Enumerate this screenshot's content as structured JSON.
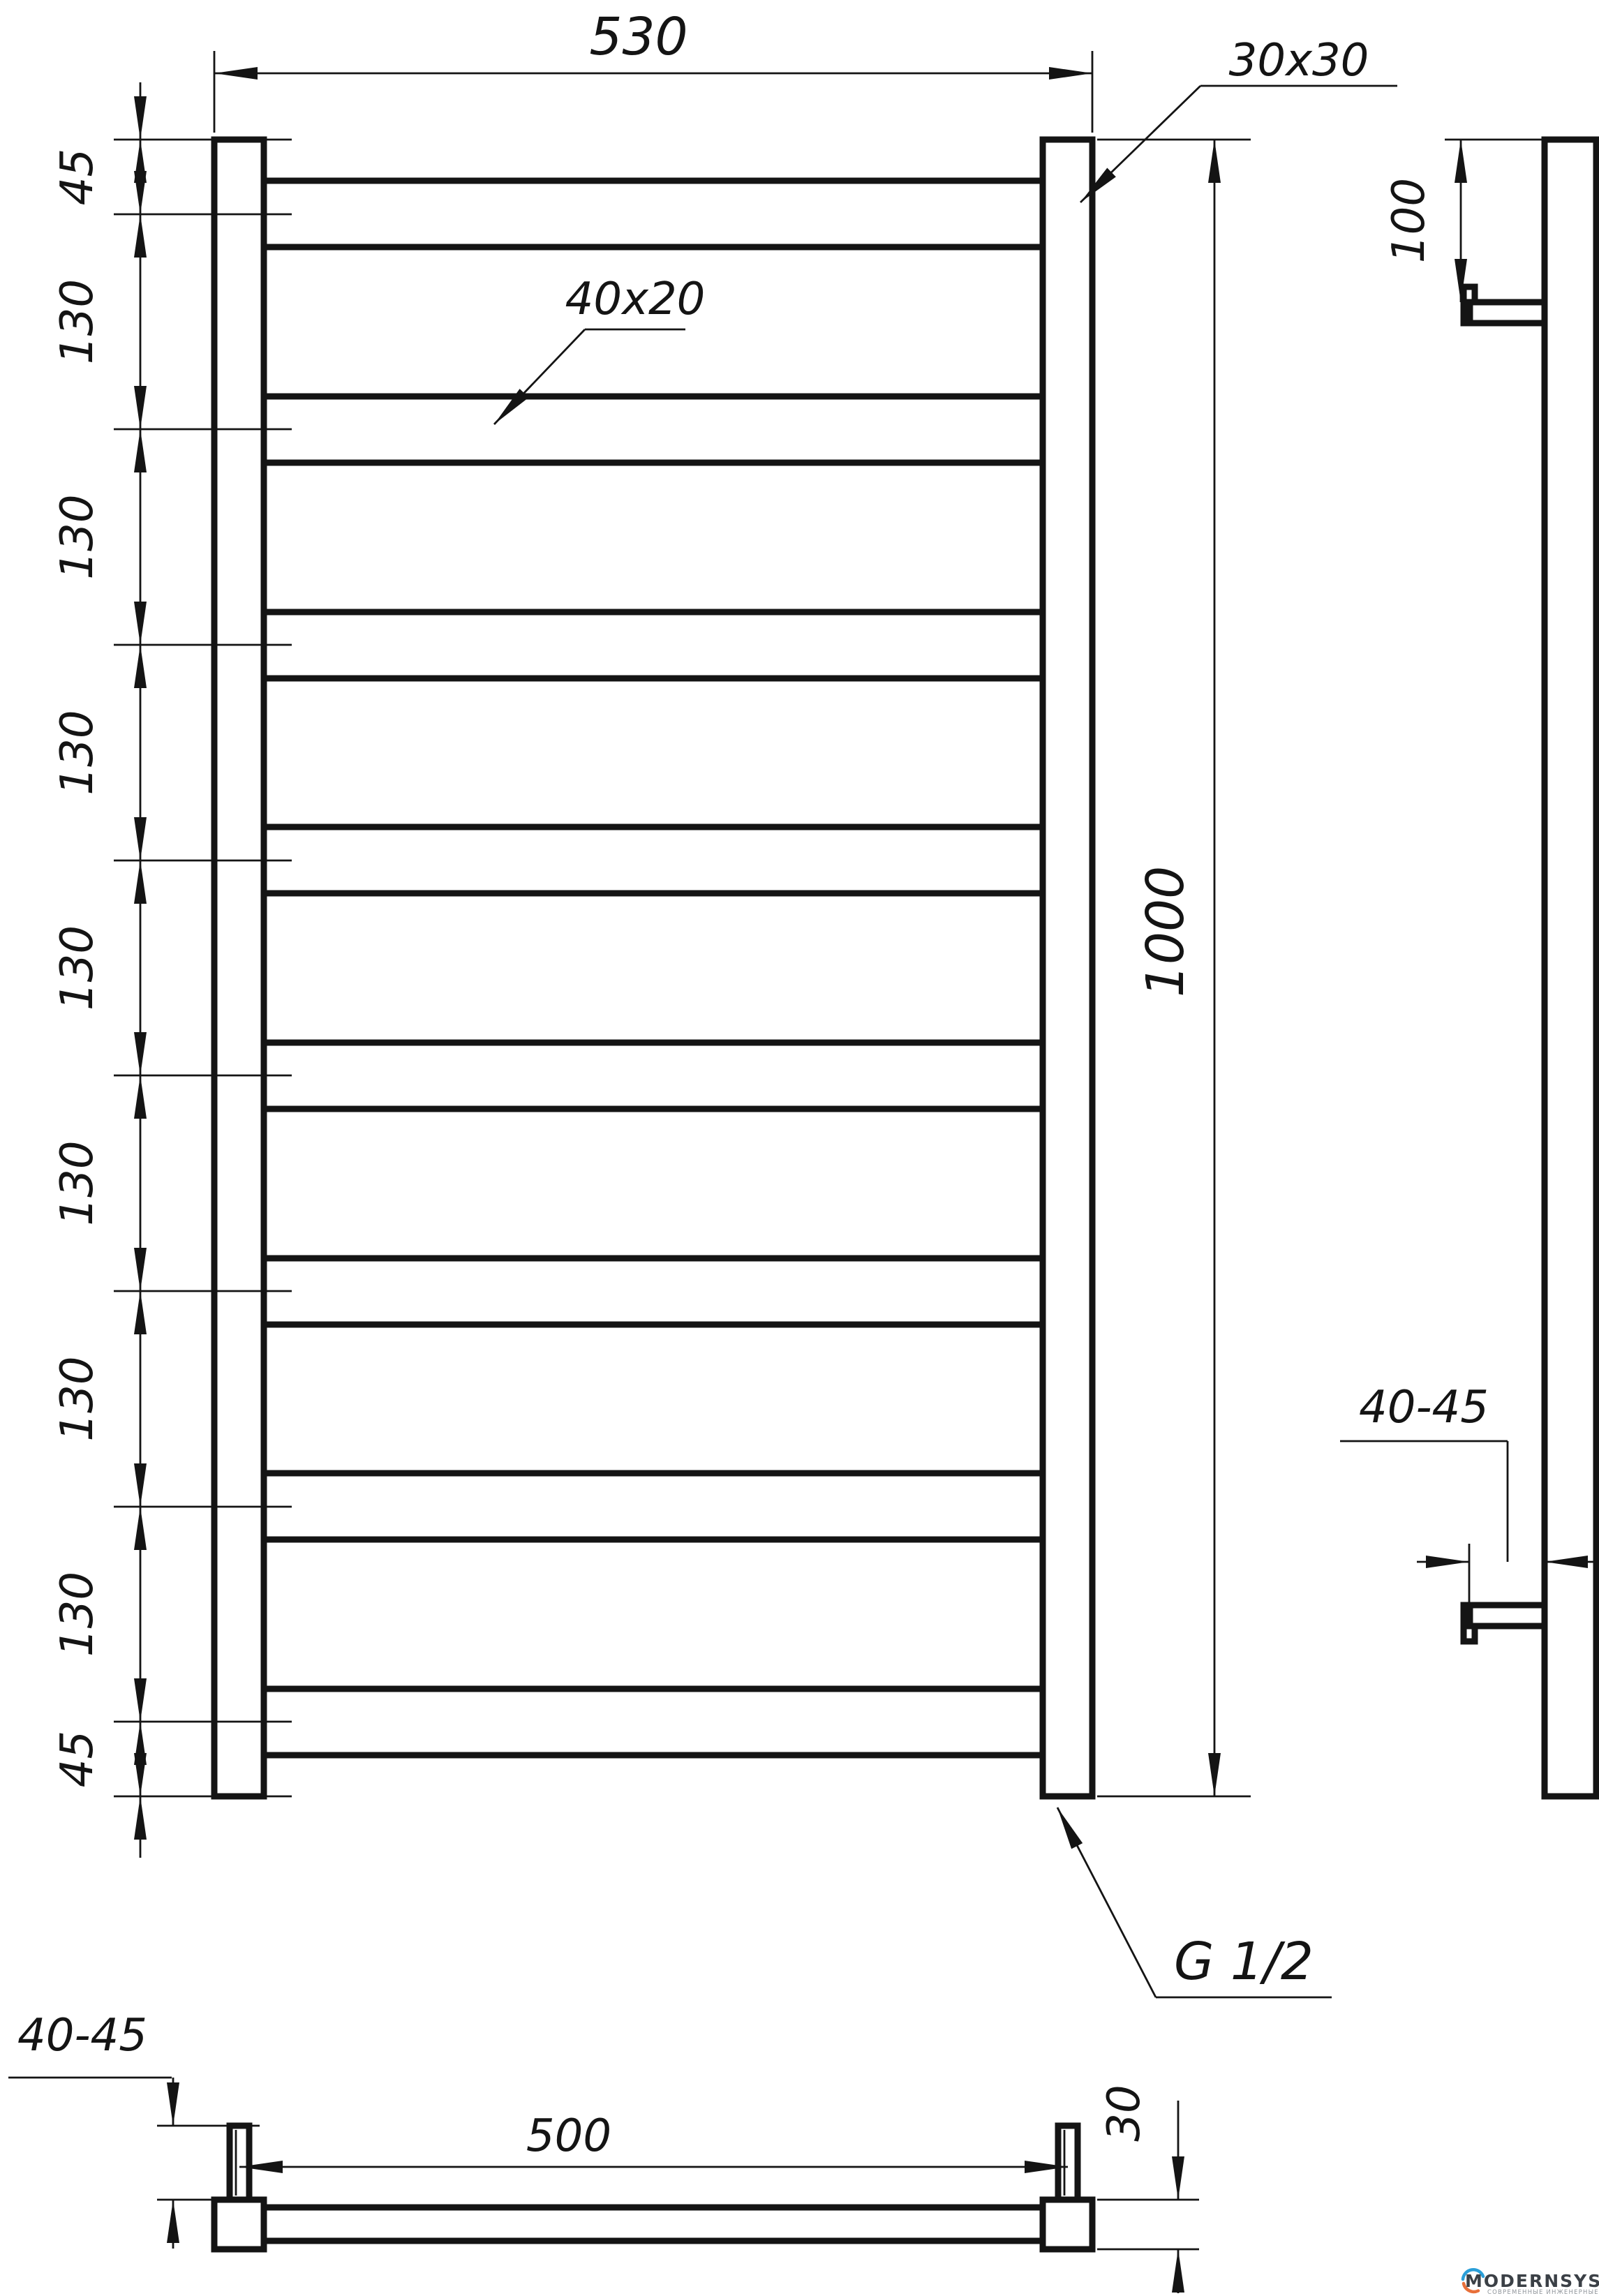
{
  "sheet": {
    "background": "#ffffff",
    "line_color": "#141414"
  },
  "front_view": {
    "overall_width": "530",
    "post_profile": "30x30",
    "rung_profile": "40x20",
    "overall_height": "1000",
    "thread": "G 1/2",
    "spacing_chain": [
      "45",
      "130",
      "130",
      "130",
      "130",
      "130",
      "130",
      "130",
      "45"
    ]
  },
  "side_view": {
    "top_bracket_offset": "100",
    "wall_clearance": "40-45"
  },
  "bottom_view": {
    "bracket_spacing": "500",
    "tube_depth": "30",
    "wall_clearance": "40-45"
  },
  "logo": {
    "name": "MODERNSYS",
    "tagline": "СОВРЕМЕННЫЕ ИНЖЕНЕРНЫЕ СИСТЕМЫ",
    "arc_top_color": "#2b9fd8",
    "arc_bottom_color": "#e8703a",
    "text_color": "#3b4046",
    "tagline_color": "#8f949a"
  }
}
